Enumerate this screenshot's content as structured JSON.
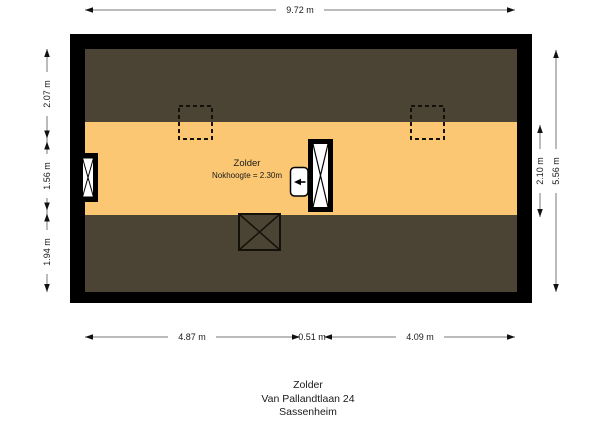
{
  "plan": {
    "room": {
      "label": "Zolder",
      "note": "Nokhoogte = 2.30m"
    },
    "colors": {
      "wall": "#000000",
      "roof": "#4b4434",
      "floor": "#fbc773",
      "symbol_stroke": "#14110b",
      "dim_line": "#777777",
      "dim_arrow": "#111111"
    }
  },
  "dimensions": {
    "top": {
      "label": "9.72 m"
    },
    "left": {
      "segments": [
        "2.07 m",
        "1.56 m",
        "1.94 m"
      ]
    },
    "right": {
      "inner": "2.10 m",
      "outer": "5.56 m"
    },
    "bottom": {
      "segments": [
        "4.87 m",
        "0.51 m",
        "4.09 m"
      ]
    }
  },
  "caption": {
    "lines": [
      "Zolder",
      "Van Pallandtlaan 24",
      "Sassenheim"
    ]
  }
}
